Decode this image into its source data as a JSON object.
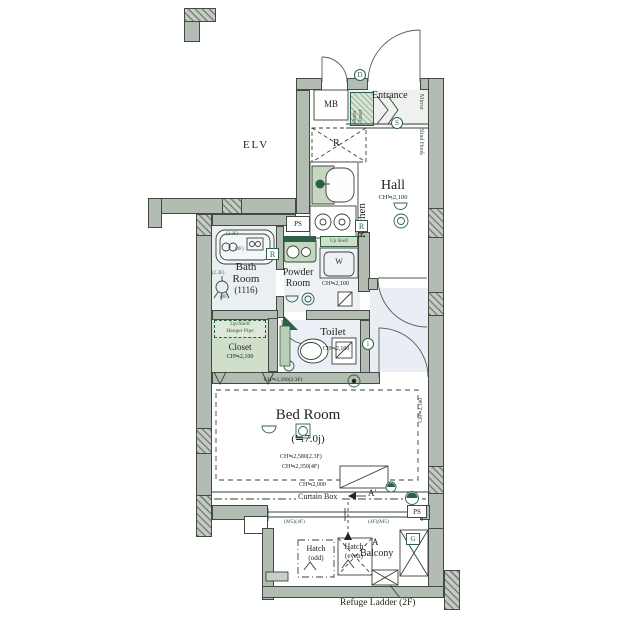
{
  "colors": {
    "wall": "#b3bcb3",
    "wb": "#434a43",
    "wet": "#e9eff3",
    "grn": "#2c6147",
    "glt": "#cfdfca",
    "ink": "#20261f"
  },
  "labels": {
    "elv": "ELV",
    "mb": "MB",
    "entrance": "Entrance",
    "mirror": "Mirror",
    "shoes_closet": "Shoes\nCloset",
    "door_mark": "D",
    "step_mark": "S",
    "blind_hook": "Blind Hook",
    "kitchen": "Kitchen",
    "fridge_mark": "R",
    "kitchen_remote_mark": "R",
    "bath_remote_mark": "R",
    "hall": "Hall",
    "hall_ch": "CH≒2,100",
    "ps_top": "PS",
    "ps_bottom": "PS",
    "powder_line1": "Powder",
    "powder_line2": "Room",
    "powder_ch": "CH≒2,100",
    "up_shelf": "Up Shelf",
    "washer_mark": "W",
    "bath_line1": "Bath",
    "bath_line2": "Room",
    "bath_line3": "(1116)",
    "tub_note_upper": "(2.3F)",
    "tub_note_lower": "(4F)",
    "shower_note_upper": "(2.3F)",
    "shower_note_lower": "(4F)",
    "toilet": "Toilet",
    "toilet_ch": "CH≒2,100",
    "closet_shelf_line1": "Up/Shelf",
    "closet_shelf_line2": "Hanger Pipe",
    "closet": "Closet",
    "closet_ch": "CH≒2,100",
    "bedroom_ch_top": "CH≒2,280(2.3F)",
    "bedroom": "Bed Room",
    "bedroom_size": "(≒7.0j)",
    "bedroom_ch1": "CH≒2,580(2.3F)",
    "bedroom_ch2": "CH≒2,350(4F)",
    "bedroom_ch3": "CH≒2,000",
    "bedroom_ch_right": "CH≒2,100",
    "intercom_mark": "i",
    "curtain_box": "Curtain Box",
    "section_a_prime": "A'",
    "section_a": "A",
    "window_left": "(M5)(4F)",
    "window_right": "(4F)(M5)",
    "hatch_odd_1": "Hatch",
    "hatch_odd_2": "(odd)",
    "hatch_even_1": "Hatch",
    "hatch_even_2": "(even)",
    "balcony": "Balcony",
    "gas_mark": "G",
    "refuge_ladder": "Refuge Ladder (2F)"
  },
  "icons": {
    "entrance_door": "swing-arc",
    "mb_door": "swing-arc",
    "hall_door": "swing-arc",
    "bedroom_door": "swing-arc",
    "toilet_door": "swing-arc",
    "tub": "bathtub",
    "shower": "shower-head",
    "washbasin": "vanity-double-circle",
    "washer_pan": "washing-machine-pan",
    "fridge_space": "dashed-cross-box",
    "sink": "kitchen-sink",
    "stove": "two-burner-stove",
    "toilet_bowl": "toilet",
    "ceiling_light": "double-circle",
    "wall_light": "half-circle",
    "downlight": "circle-dot",
    "outdoor_faucet": "circle-half-disc",
    "refuge_hatch": "bowtie-box",
    "gas_meter": "crossed-box",
    "ac_unit": "diagonal-rect",
    "window": "double-line",
    "section_line": "A-A'"
  }
}
